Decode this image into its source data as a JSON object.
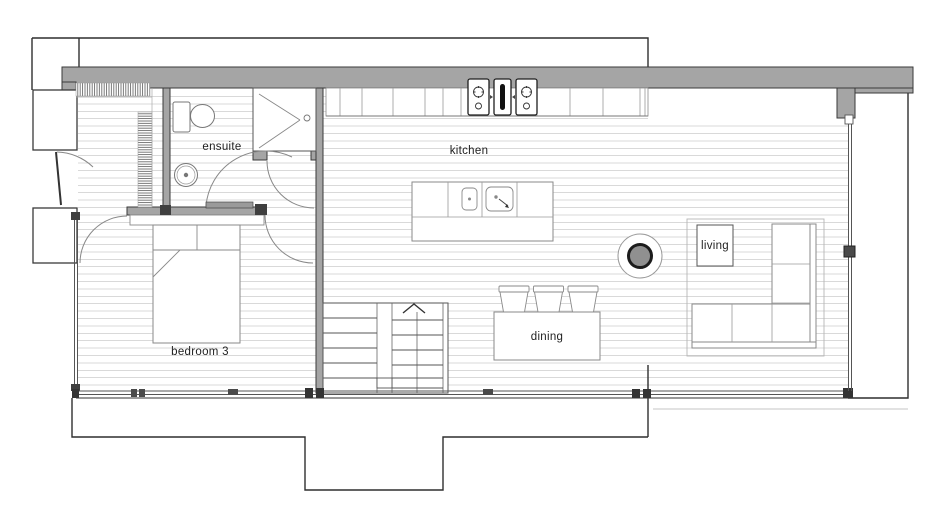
{
  "rooms": [
    {
      "id": "ensuite",
      "label": "ensuite"
    },
    {
      "id": "kitchen",
      "label": "kitchen"
    },
    {
      "id": "living",
      "label": "living"
    },
    {
      "id": "dining",
      "label": "dining"
    },
    {
      "id": "bedroom3",
      "label": "bedroom 3"
    }
  ],
  "fixtures": [
    "wardrobe-hanging-rail",
    "toilet",
    "washbasin",
    "shower",
    "kitchen-cabinets",
    "cooktop",
    "kitchen-island",
    "double-sink",
    "staircase",
    "up-arrow",
    "dining-table",
    "dining-chairs",
    "l-shaped-sofa",
    "fireplace",
    "double-bed",
    "door-swings",
    "glazed-walls",
    "deck"
  ],
  "colors": {
    "wall_fill": "#a5a5a5",
    "wall_outline": "#3a3a3a",
    "site_outline": "#2f2f2f",
    "floorboards": "#d9d9d9",
    "fixture_stroke": "#8a8a8a",
    "glass": "#555555"
  }
}
